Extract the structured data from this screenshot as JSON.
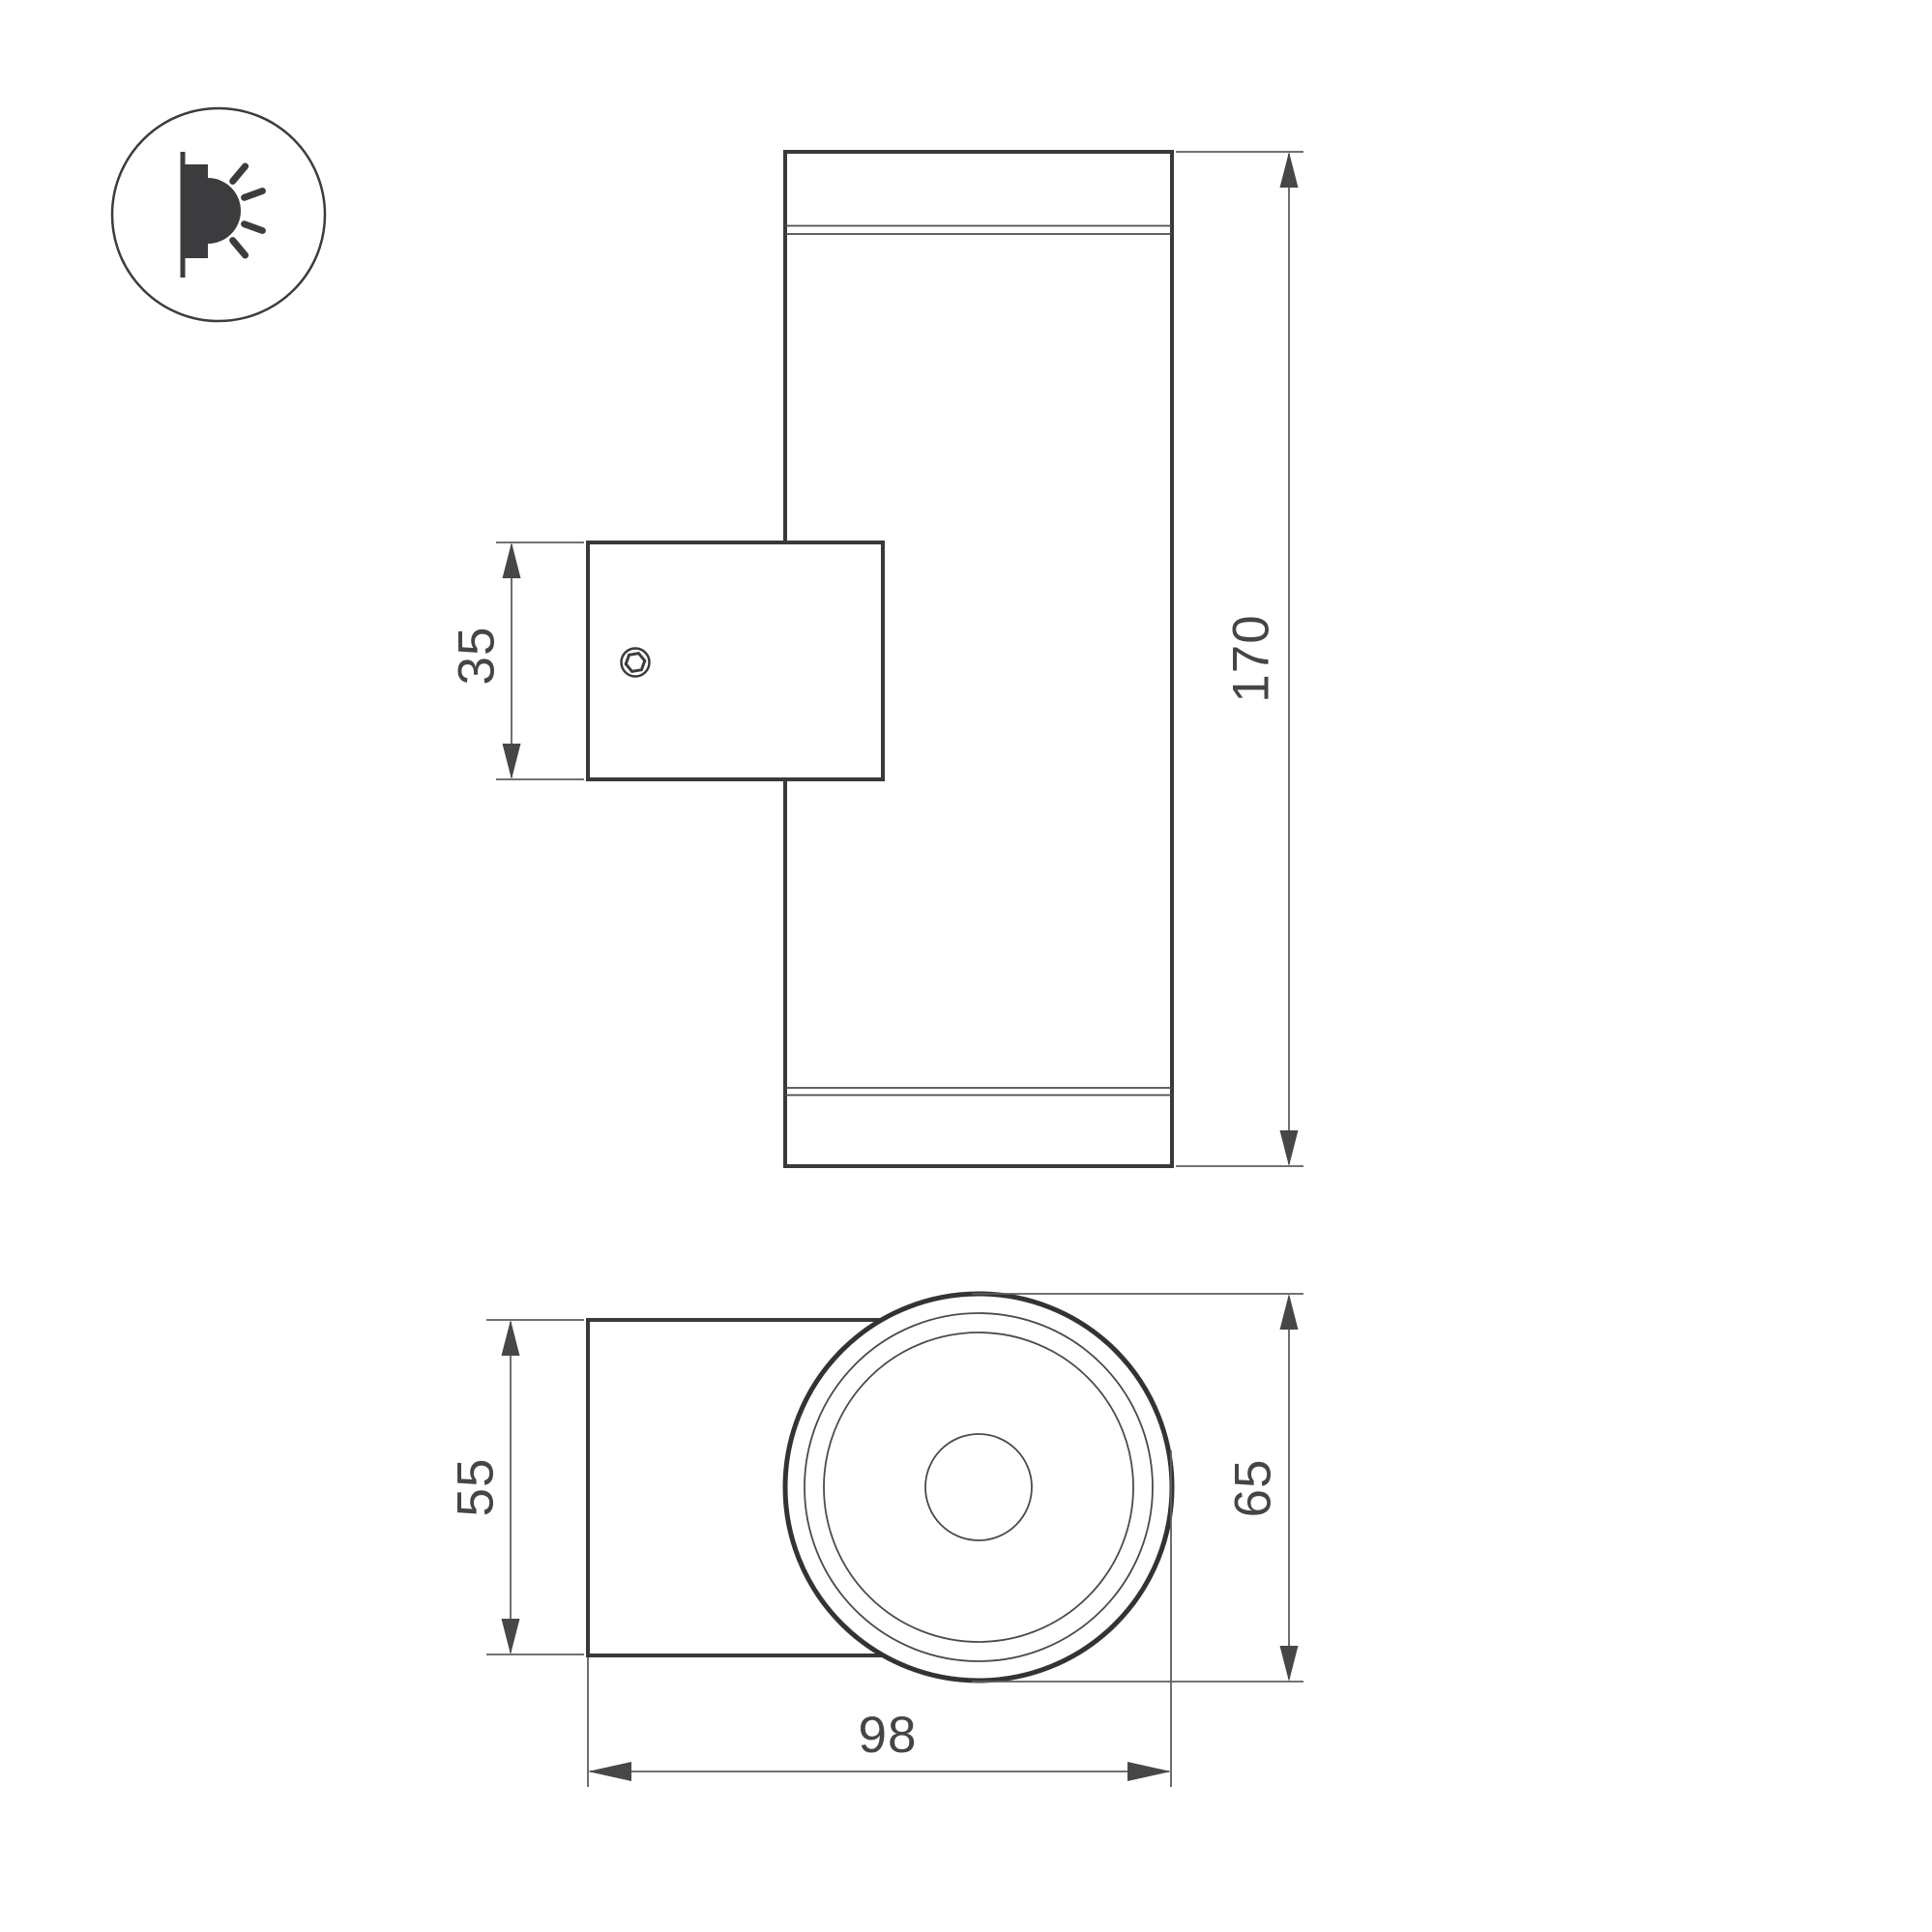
{
  "drawing": {
    "title": "wall-mounted up-down luminaire dimensional drawing",
    "views": {
      "front_view": "cylindrical body with wall-mount bracket",
      "side_view": "mount plate and round lamp face with concentric rings"
    },
    "dimensions": {
      "bracket_height": "35",
      "overall_height": "170",
      "plate_height": "55",
      "head_diameter": "65",
      "overall_depth": "98"
    },
    "icon": {
      "name": "wall-light-emitting-icon",
      "description": "wall sconce emitting light rays"
    },
    "colors": {
      "outline": "#39393b",
      "thin_line": "#4b4b4d",
      "dimension_line": "#5e5e62",
      "arrow": "#47474a",
      "text": "#454548",
      "background": "#ffffff"
    }
  }
}
